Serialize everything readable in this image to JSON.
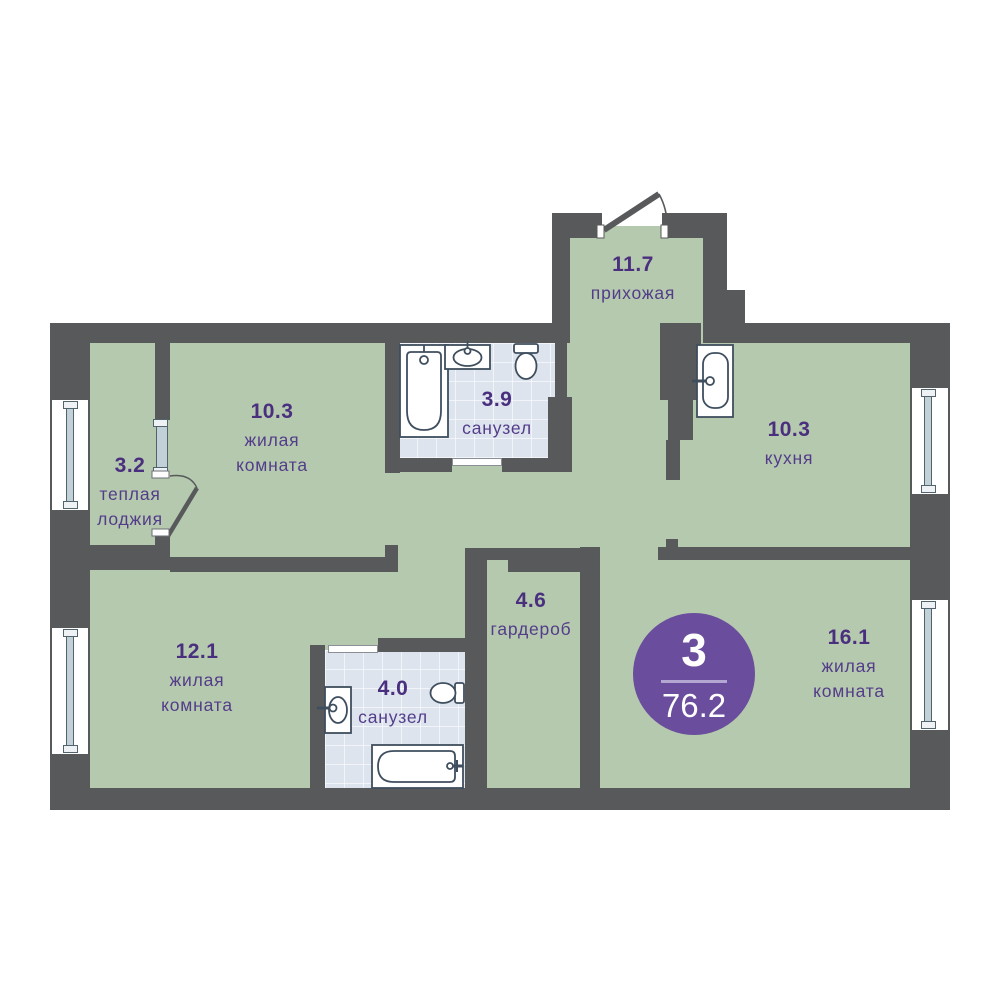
{
  "plan": {
    "type": "apartment-floor-plan",
    "badge": {
      "rooms_count": "3",
      "total_area": "76.2"
    },
    "rooms": [
      {
        "id": "hallway",
        "area": "11.7",
        "name": "прихожая"
      },
      {
        "id": "warm-loggia",
        "area": "3.2",
        "name": "теплая лоджия"
      },
      {
        "id": "living-room-1",
        "area": "10.3",
        "name": "жилая комната"
      },
      {
        "id": "bathroom-1",
        "area": "3.9",
        "name": "санузел"
      },
      {
        "id": "kitchen",
        "area": "10.3",
        "name": "кухня"
      },
      {
        "id": "living-room-2",
        "area": "12.1",
        "name": "жилая комната"
      },
      {
        "id": "bathroom-2",
        "area": "4.0",
        "name": "санузел"
      },
      {
        "id": "wardrobe",
        "area": "4.6",
        "name": "гардероб"
      },
      {
        "id": "living-room-3",
        "area": "16.1",
        "name": "жилая комната"
      }
    ],
    "fixtures": [
      "bathtub-icon",
      "sink-icon",
      "toilet-icon",
      "kitchen-sink-icon",
      "bathtub-icon",
      "sink-icon",
      "toilet-icon"
    ],
    "colors": {
      "wall": "#58595b",
      "room_fill": "#b5c9ae",
      "bathroom_floor": "#dde4ed",
      "label_text": "#4a2f7f",
      "badge_fill": "#6a4d9c",
      "window_glass": "#c2d1d8"
    }
  }
}
